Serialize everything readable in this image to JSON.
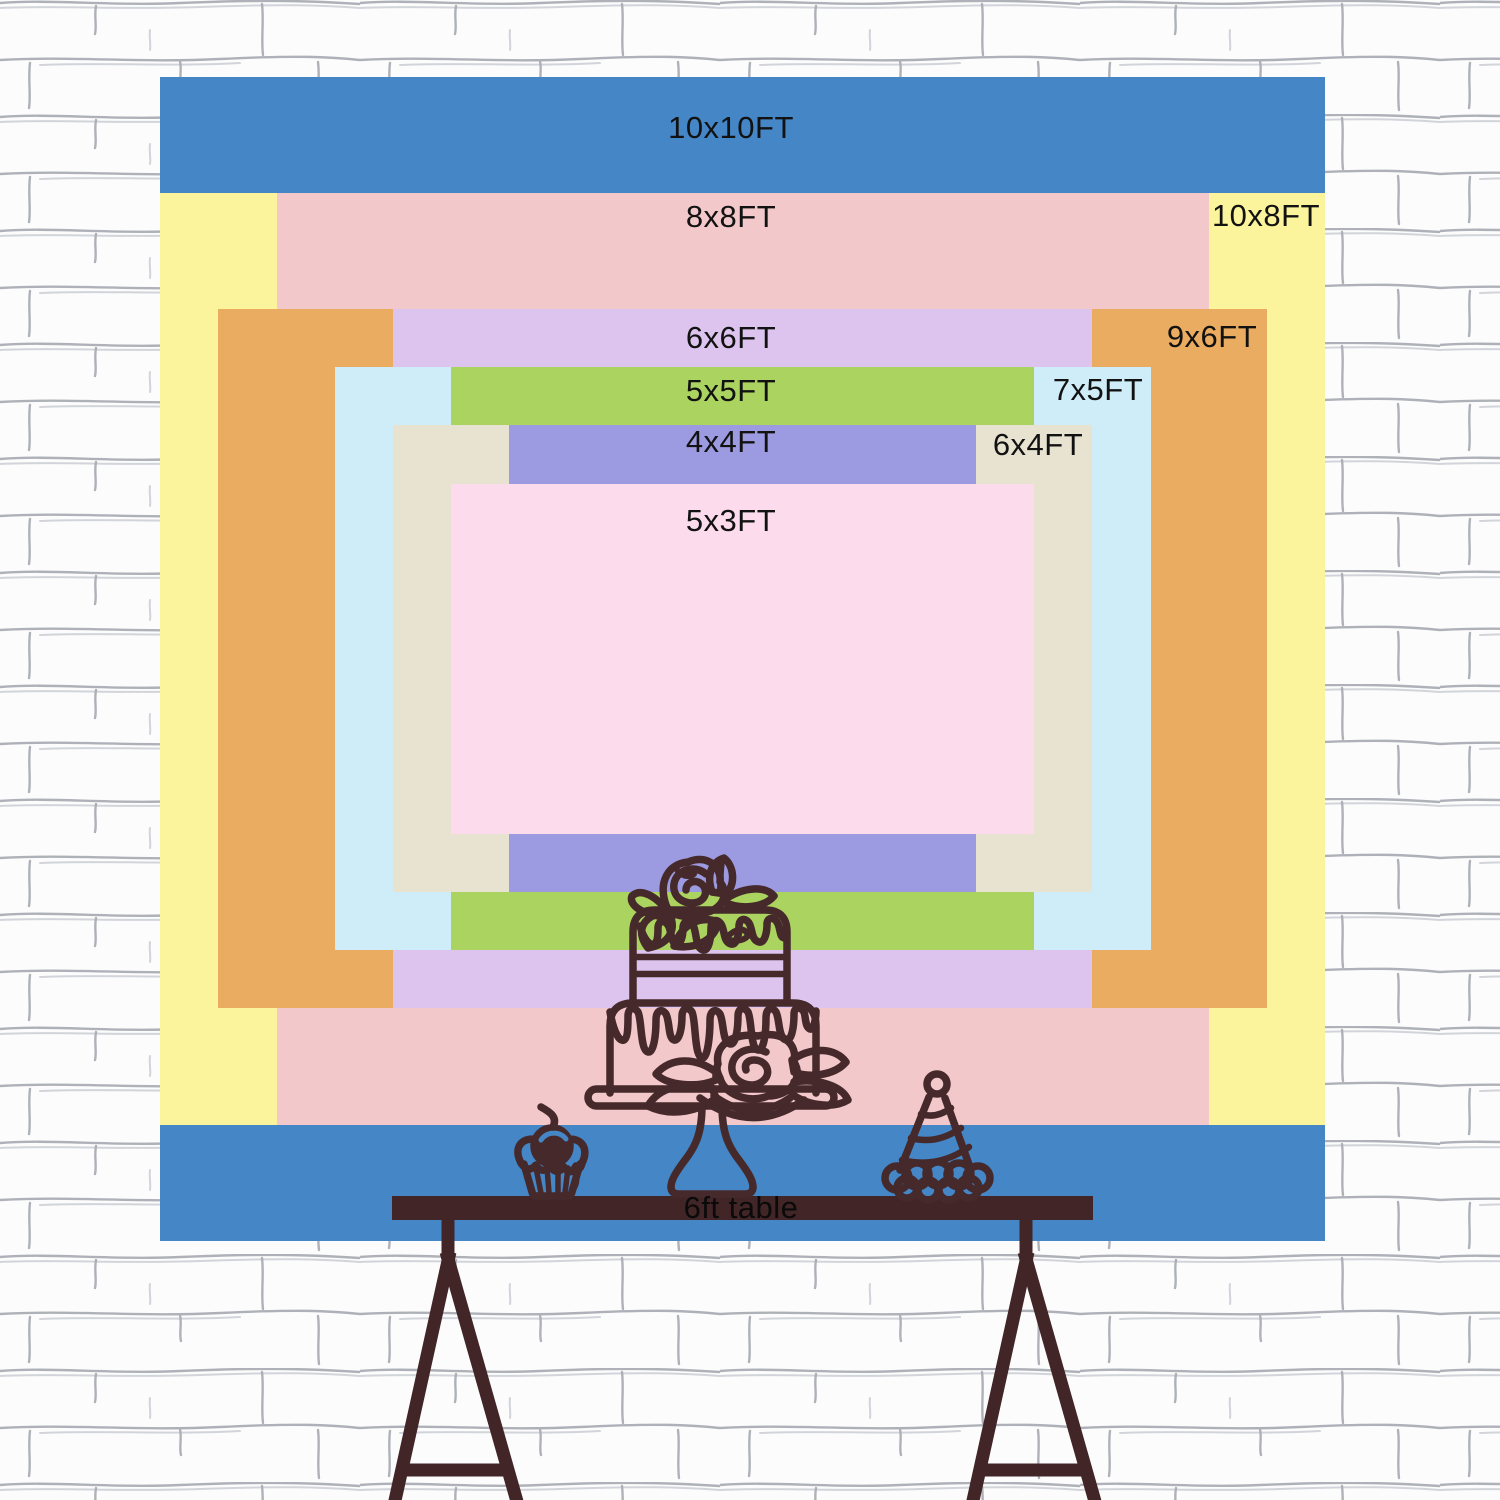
{
  "title": "backdrop size chart",
  "colors": {
    "blue": "#4486c6",
    "yellow": "#fbf49c",
    "pink": "#f2c8ca",
    "orange": "#eaac60",
    "lavender": "#dcc4ee",
    "light_blue": "#ceedf8",
    "green": "#abd35f",
    "beige": "#e7e3d0",
    "periwinkle": "#9c9be2",
    "light_pink": "#fbdbec",
    "outline_brown": "#46292b",
    "table_brown": "#422527",
    "label_text": "#121212",
    "wall_bg": "#fcfcfd",
    "wall_line": "#6d7480"
  },
  "backdrop": {
    "layers": [
      {
        "id": "10x10",
        "label": "10x10FT",
        "color": "#4486c6",
        "x": 160,
        "y": 77,
        "w": 1165,
        "h": 1164,
        "label_x": 731,
        "label_y": 128
      },
      {
        "id": "10x8",
        "label": "10x8FT",
        "color": "#fbf49c",
        "x": 160,
        "y": 193,
        "w": 1165,
        "h": 932,
        "label_x": 1266,
        "label_y": 216
      },
      {
        "id": "8x8",
        "label": "8x8FT",
        "color": "#f2c8ca",
        "x": 277,
        "y": 193,
        "w": 932,
        "h": 932,
        "label_x": 731,
        "label_y": 217
      },
      {
        "id": "9x6",
        "label": "9x6FT",
        "color": "#eaac60",
        "x": 218,
        "y": 309,
        "w": 1049,
        "h": 699,
        "label_x": 1212,
        "label_y": 337
      },
      {
        "id": "6x6",
        "label": "6x6FT",
        "color": "#dcc4ee",
        "x": 393,
        "y": 309,
        "w": 699,
        "h": 699,
        "label_x": 731,
        "label_y": 338
      },
      {
        "id": "7x5",
        "label": "7x5FT",
        "color": "#ceedf8",
        "x": 335,
        "y": 367,
        "w": 816,
        "h": 583,
        "label_x": 1098,
        "label_y": 390
      },
      {
        "id": "5x5",
        "label": "5x5FT",
        "color": "#abd35f",
        "x": 451,
        "y": 367,
        "w": 583,
        "h": 583,
        "label_x": 731,
        "label_y": 391
      },
      {
        "id": "6x4",
        "label": "6x4FT",
        "color": "#e7e3d0",
        "x": 393,
        "y": 425,
        "w": 699,
        "h": 467,
        "label_x": 1038,
        "label_y": 445
      },
      {
        "id": "4x4",
        "label": "4x4FT",
        "color": "#9c9be2",
        "x": 509,
        "y": 425,
        "w": 467,
        "h": 467,
        "label_x": 731,
        "label_y": 442
      },
      {
        "id": "5x3",
        "label": "5x3FT",
        "color": "#fbdbec",
        "x": 451,
        "y": 484,
        "w": 583,
        "h": 350,
        "label_x": 731,
        "label_y": 521
      }
    ]
  },
  "table": {
    "label": "6ft table",
    "color": "#422527",
    "x": 392,
    "y": 1196,
    "w": 701,
    "h": 24,
    "label_x": 741,
    "label_y": 1208
  },
  "icons": [
    "brick-wall-background",
    "cake-icon",
    "cupcake-icon",
    "cherry-icon",
    "party-hat-icon",
    "table-legs"
  ]
}
